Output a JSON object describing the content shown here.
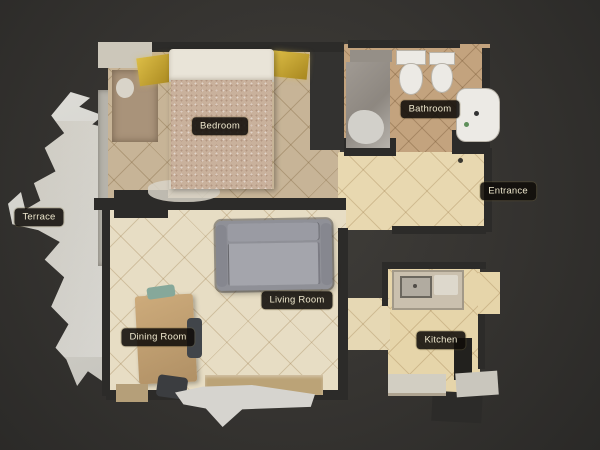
{
  "scene": {
    "type": "top-down-3d-floorplan",
    "background_color": "#363431",
    "wall_color": "#2c2b29",
    "label_background": "#100d09",
    "label_text_color": "#eee7cd"
  },
  "rooms": [
    {
      "id": "bedroom",
      "label": "Bedroom"
    },
    {
      "id": "bathroom",
      "label": "Bathroom"
    },
    {
      "id": "entrance",
      "label": "Entrance"
    },
    {
      "id": "terrace",
      "label": "Terrace"
    },
    {
      "id": "living_room",
      "label": "Living Room"
    },
    {
      "id": "dining_room",
      "label": "Dining Room"
    },
    {
      "id": "kitchen",
      "label": "Kitchen"
    }
  ],
  "palette": {
    "bedroom_floor": "#c7b497",
    "living_floor": "#e7ddc4",
    "entrance_floor": "#e8d8b0",
    "kitchen_floor": "#e6d5aa",
    "bathroom_floor": "#c3a37e",
    "terrace_surface": "#d8d7d2",
    "bed_blanket": "#c9b19c",
    "bed_pillows": "#e9e4d8",
    "nightstand_gold": "#cbaa3c",
    "couch_gray": "#9a9ba3",
    "table_wood": "#c2a472"
  }
}
